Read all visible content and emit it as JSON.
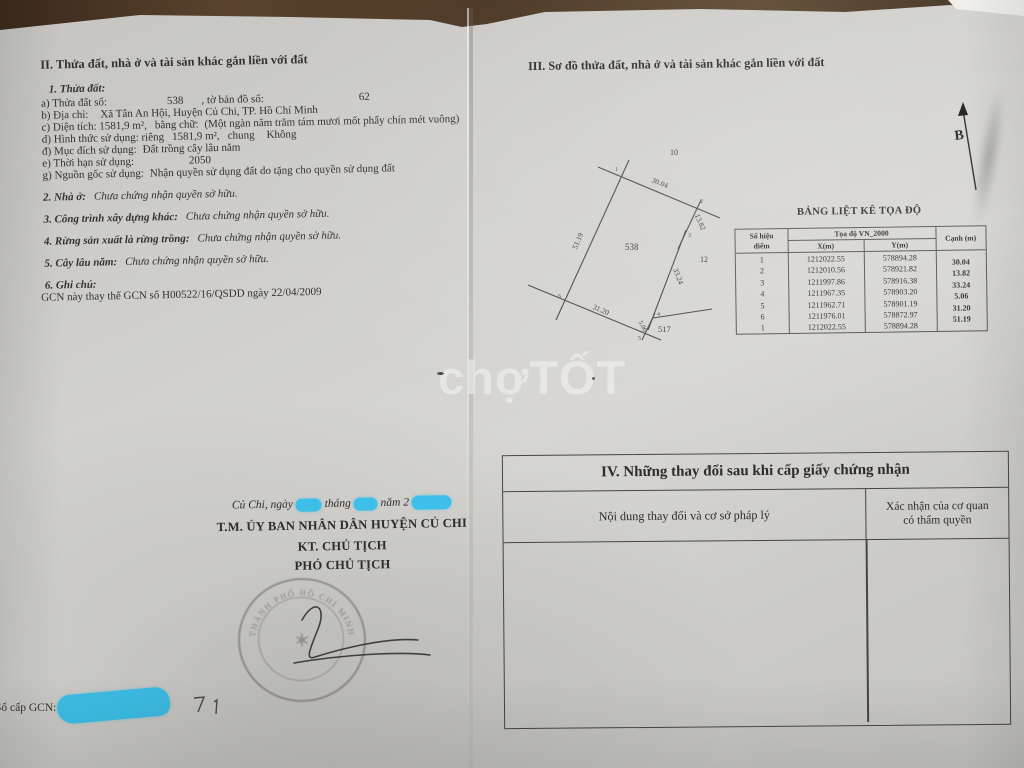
{
  "watermark": {
    "part1": "chợ",
    "part2": "TỐT"
  },
  "left_page": {
    "section_title": "II. Thửa đất, nhà ở và tài sản khác gắn liền với đất",
    "parcel_heading": "1. Thửa đất:",
    "fields": [
      {
        "label": "a) Thửa đất số:",
        "value": "538",
        "label2": ", tờ bản đồ số:",
        "value2": "62"
      },
      {
        "label": "b) Địa chỉ:",
        "value": "Xã Tân An Hội, Huyện Củ Chi, TP. Hồ Chí Minh"
      },
      {
        "label": "c) Diện tích: 1581,9 m²,",
        "label2": "bằng chữ:",
        "value2": "(Một ngàn năm trăm tám mươi mốt phẩy chín mét vuông)"
      },
      {
        "label": "d) Hình thức sử dụng: riêng",
        "value": "1581,9 m²,",
        "label2": "chung",
        "value2": "Không"
      },
      {
        "label": "đ) Mục đích sử dụng:",
        "value": "Đất trồng cây lâu năm"
      },
      {
        "label": "e) Thời hạn sử dụng:",
        "value": "2050"
      },
      {
        "label": "g) Nguồn gốc sử dụng:",
        "value": "Nhận quyền sử dụng đất do tặng cho quyền sử dụng đất"
      }
    ],
    "statements": [
      {
        "label": "2. Nhà ở:",
        "value": "Chưa chứng nhận quyền sở hữu."
      },
      {
        "label": "3. Công trình xây dựng khác:",
        "value": "Chưa chứng nhận quyền sở hữu."
      },
      {
        "label": "4. Rừng sản xuất là rừng trồng:",
        "value": "Chưa chứng nhận quyền sở hữu."
      },
      {
        "label": "5. Cây lâu năm:",
        "value": "Chưa chứng nhận quyền sở hữu."
      }
    ],
    "note_heading": "6. Ghi chú:",
    "note_text": "GCN này thay thế GCN số H00522/16/QSDD ngày 22/04/2009",
    "signature": {
      "date_part1": "Củ Chi, ngày",
      "date_part2": "tháng",
      "date_part3": "năm 2",
      "line1": "T.M. ỦY BAN NHÂN DÂN HUYỆN CỦ CHI",
      "line2": "KT. CHỦ TỊCH",
      "line3": "PHÓ CHỦ TỊCH",
      "stamp_arc_text": "THÀNH PHỐ HỒ CHÍ MINH"
    },
    "gcn_label": "Số cấp GCN:"
  },
  "right_page": {
    "section_title": "III. Sơ đồ thửa đất, nhà ở và tài sản khác gắn liền với đất",
    "north_label": "B",
    "diagram": {
      "parcel_number": "538",
      "adjacent_north": "10",
      "adjacent_east": "12",
      "adjacent_south": "517",
      "edge_labels": [
        "30.04",
        "13.82",
        "33.24",
        "5.06",
        "31.20",
        "51.19"
      ],
      "vertex_labels": [
        "1",
        "2",
        "3",
        "4",
        "5",
        "6"
      ]
    },
    "coord_table": {
      "title": "BẢNG LIỆT KÊ TỌA ĐỘ",
      "col_point_line1": "Số hiệu",
      "col_point_line2": "điểm",
      "col_coord": "Tọa độ VN_2000",
      "col_x": "X(m)",
      "col_y": "Y(m)",
      "col_edge": "Cạnh (m)",
      "rows": [
        {
          "p": "1",
          "x": "1212022.55",
          "y": "578894.28"
        },
        {
          "p": "2",
          "x": "1212010.56",
          "y": "578921.82"
        },
        {
          "p": "3",
          "x": "1211997.86",
          "y": "578916.38"
        },
        {
          "p": "4",
          "x": "1211967.35",
          "y": "578903.20"
        },
        {
          "p": "5",
          "x": "1211962.71",
          "y": "578901.19"
        },
        {
          "p": "6",
          "x": "1211976.01",
          "y": "578872.97"
        },
        {
          "p": "1",
          "x": "1212022.55",
          "y": "578894.28"
        }
      ],
      "edge_values": [
        "30.04",
        "13.82",
        "33.24",
        "5.06",
        "31.20",
        "51.19"
      ]
    },
    "changes_table": {
      "title": "IV. Những thay đổi sau khi cấp giấy chứng nhận",
      "col1": "Nội dung thay đổi và cơ sở pháp lý",
      "col2_line1": "Xác nhận của cơ quan",
      "col2_line2": "có thẩm quyền"
    }
  },
  "colors": {
    "redaction_blue": "#3ec7f2",
    "paper": "#d2d1cd",
    "wood": "#4a3522",
    "ink": "#34312c"
  }
}
